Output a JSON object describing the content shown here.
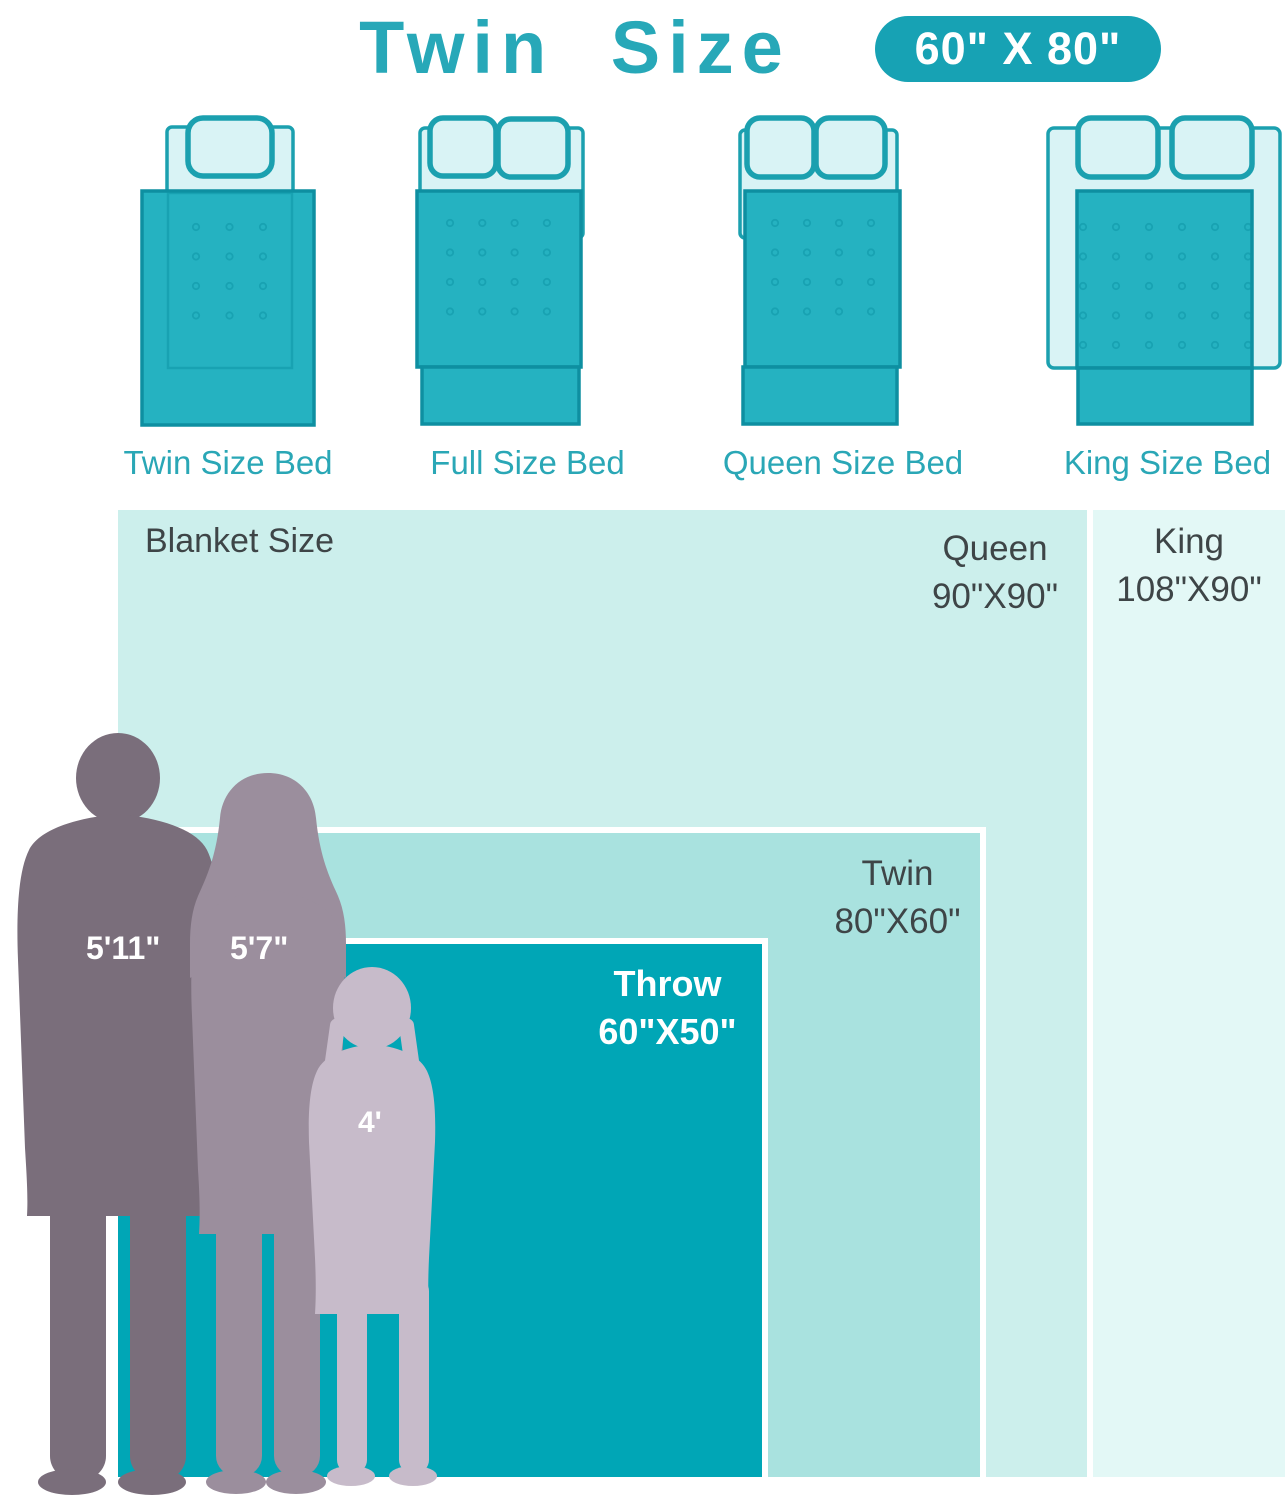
{
  "header": {
    "title": "Twin Size",
    "badge": "60\" X 80\""
  },
  "beds": {
    "items": [
      {
        "label": "Twin Size Bed"
      },
      {
        "label": "Full Size Bed"
      },
      {
        "label": "Queen Size Bed"
      },
      {
        "label": "King Size Bed"
      }
    ]
  },
  "comparison": {
    "section_label": "Blanket Size",
    "king": {
      "name": "King",
      "size": "108\"X90\""
    },
    "queen": {
      "name": "Queen",
      "size": "90\"X90\""
    },
    "twin": {
      "name": "Twin",
      "size": "80\"X60\""
    },
    "throw": {
      "name": "Throw",
      "size": "60\"X50\""
    },
    "people": {
      "man": {
        "height": "5'11\""
      },
      "woman": {
        "height": "5'7\""
      },
      "girl": {
        "height": "4'"
      }
    }
  },
  "colors": {
    "accent_teal": "#17a2b4",
    "title_teal": "#27a8b8",
    "bed_blanket": "#25b2c1",
    "throw_fill": "#00a6b6",
    "twin_fill": "#a9e2df",
    "queen_fill": "#ccefec",
    "king_fill": "#e3f8f6",
    "text_dark": "#3e4547",
    "man_silhouette": "#7a6e7b",
    "woman_silhouette": "#9b8e9d",
    "girl_silhouette": "#c7bbca"
  }
}
